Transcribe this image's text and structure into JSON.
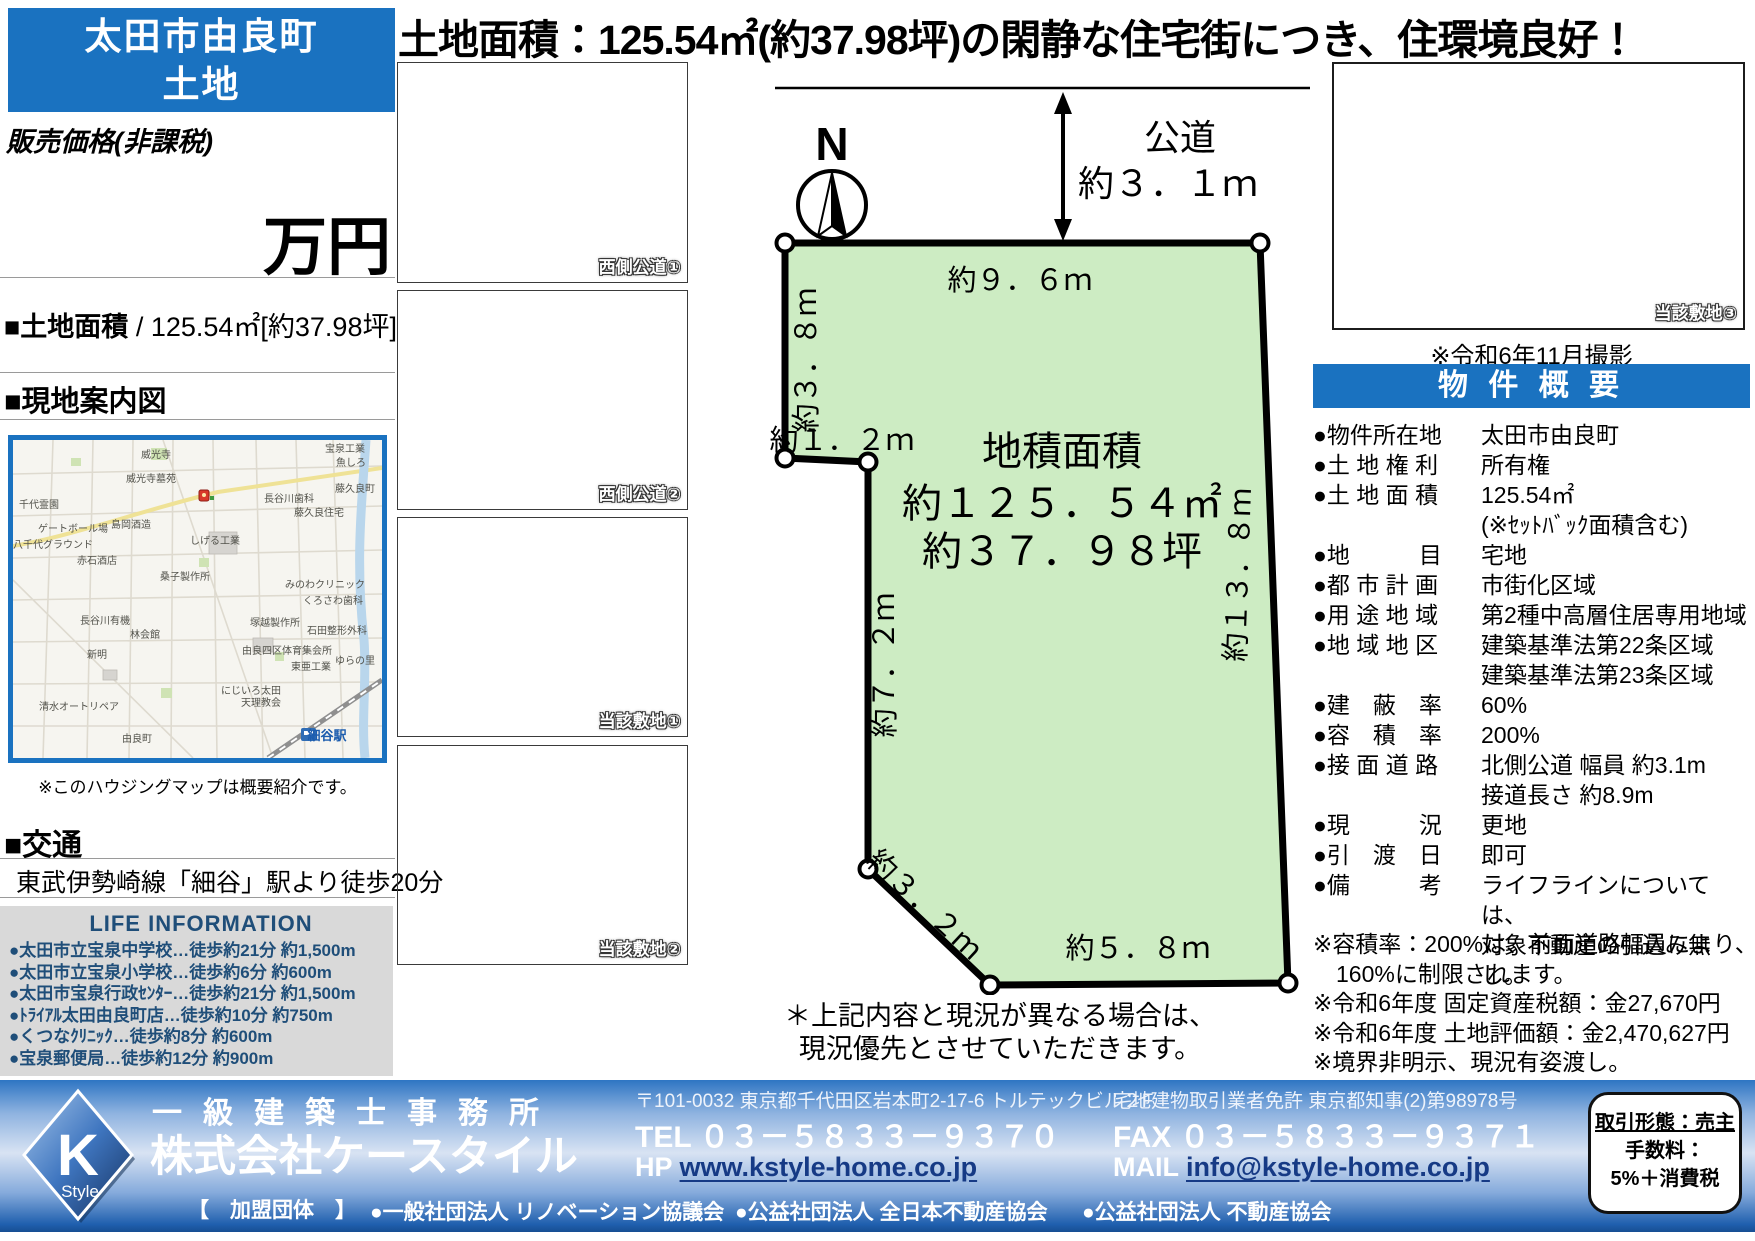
{
  "page": {
    "headline": "土地面積：125.54㎡(約37.98坪)の閑静な住宅街につき、住環境良好！"
  },
  "left": {
    "title_line1": "太田市由良町",
    "title_line2": "土地",
    "price_label": "販売価格(非課税)",
    "price_unit": "万円",
    "area_label": "■土地面積",
    "area_value": " / 125.54㎡[約37.98坪]",
    "map_header": "■現地案内図",
    "map_note": "※このハウジングマップは概要紹介です。",
    "access_header": "■交通",
    "access_value": "東武伊勢崎線「細谷」駅より徒歩20分",
    "life": {
      "header": "LIFE INFORMATION",
      "items": [
        "●太田市立宝泉中学校…徒歩約21分 約1,500m",
        "●太田市立宝泉小学校…徒歩約6分 約600m",
        "●太田市宝泉行政ｾﾝﾀｰ…徒歩約21分 約1,500m",
        "●ﾄﾗｲｱﾙ太田由良町店…徒歩約10分 約750m",
        "●くつなｸﾘﾆｯｸ…徒歩約8分 約600m",
        "●宝泉郵便局…徒歩約12分 約900m"
      ]
    }
  },
  "map": {
    "labels": [
      {
        "text": "宝泉工業",
        "x": 332,
        "y": 12
      },
      {
        "text": "魚しろ",
        "x": 338,
        "y": 26
      },
      {
        "text": "威光寺",
        "x": 143,
        "y": 18
      },
      {
        "text": "威光寺墓苑",
        "x": 138,
        "y": 42
      },
      {
        "text": "千代霊園",
        "x": 26,
        "y": 68
      },
      {
        "text": "藤久良町",
        "x": 342,
        "y": 52
      },
      {
        "text": "長谷川歯科",
        "x": 276,
        "y": 62
      },
      {
        "text": "藤久良住宅",
        "x": 306,
        "y": 76
      },
      {
        "text": "ゲートボール場",
        "x": 60,
        "y": 92
      },
      {
        "text": "島岡酒造",
        "x": 118,
        "y": 88
      },
      {
        "text": "八千代グラウンド",
        "x": 40,
        "y": 108
      },
      {
        "text": "しげる工業",
        "x": 202,
        "y": 104
      },
      {
        "text": "赤石酒店",
        "x": 84,
        "y": 124
      },
      {
        "text": "桑子製作所",
        "x": 172,
        "y": 140
      },
      {
        "text": "みのわクリニック",
        "x": 312,
        "y": 148
      },
      {
        "text": "くろさわ歯科",
        "x": 320,
        "y": 164
      },
      {
        "text": "長谷川有機",
        "x": 92,
        "y": 184
      },
      {
        "text": "塚越製作所",
        "x": 262,
        "y": 186
      },
      {
        "text": "林会館",
        "x": 132,
        "y": 198
      },
      {
        "text": "石田整形外科",
        "x": 324,
        "y": 194
      },
      {
        "text": "新明",
        "x": 84,
        "y": 218
      },
      {
        "text": "由良四区体育集会所",
        "x": 274,
        "y": 214
      },
      {
        "text": "東亜工業",
        "x": 298,
        "y": 230
      },
      {
        "text": "ゆらの里",
        "x": 342,
        "y": 224
      },
      {
        "text": "にじいろ太田",
        "x": 238,
        "y": 254
      },
      {
        "text": "天理教会",
        "x": 248,
        "y": 266
      },
      {
        "text": "清水オートリペア",
        "x": 66,
        "y": 270
      },
      {
        "text": "由良町",
        "x": 124,
        "y": 302
      },
      {
        "text": "細谷駅",
        "x": 314,
        "y": 300,
        "cls": "st"
      }
    ]
  },
  "photos": {
    "captions": [
      "西側公道①",
      "西側公道②",
      "当該敷地①",
      "当該敷地②",
      "当該敷地③"
    ],
    "shot_note": "※令和6年11月撮影"
  },
  "plot": {
    "north": "N",
    "road_label1": "公道",
    "road_label2": "約３．１ｍ",
    "top": "約９．６ｍ",
    "left1": "約３．８ｍ",
    "step": "約１．２ｍ",
    "left2": "約７．２ｍ",
    "right": "約１３．８ｍ",
    "diag": "約３．２ｍ",
    "bottom": "約５．８ｍ",
    "area_title": "地積面積",
    "area_m2": "約１２５．５４㎡",
    "area_tsubo": "約３７．９８坪",
    "disclaimer1": "＊上記内容と現況が異なる場合は、",
    "disclaimer2": "現況優先とさせていただきます。"
  },
  "overview": {
    "header": "物 件 概 要",
    "rows": [
      {
        "label": "●物件所在地",
        "value": "太田市由良町"
      },
      {
        "label": "●土 地 権 利",
        "value": "所有権"
      },
      {
        "label": "●土 地 面 積",
        "value": "125.54㎡\n(※ｾｯﾄﾊﾞｯｸ面積含む)"
      },
      {
        "label": "●地　　　目",
        "value": "宅地"
      },
      {
        "label": "●都 市 計 画",
        "value": "市街化区域"
      },
      {
        "label": "●用 途 地 域",
        "value": "第2種中高層住居専用地域"
      },
      {
        "label": "●地 域 地 区",
        "value": "建築基準法第22条区域\n建築基準法第23条区域"
      },
      {
        "label": "●建　蔽　率",
        "value": "60%"
      },
      {
        "label": "●容　積　率",
        "value": "200%"
      },
      {
        "label": "●接 面 道 路",
        "value": "北側公道 幅員 約3.1m\n接道長さ 約8.9m"
      },
      {
        "label": "●現　　　況",
        "value": "更地"
      },
      {
        "label": "●引　渡　日",
        "value": "即可"
      },
      {
        "label": "●備　　　考",
        "value": "ライフラインについては、\n対象不動産の引込み無し。"
      }
    ],
    "notes": [
      "※容積率：200%は、前面道路幅員により、\n　160%に制限されます。",
      "※令和6年度 固定資産税額：金27,670円",
      "※令和6年度 土地評価額：金2,470,627円",
      "※境界非明示、現況有姿渡し。"
    ]
  },
  "footer": {
    "logo_k": "K",
    "logo_style": "Style",
    "office_type": "一級建築士事務所",
    "company": "株式会社ケースタイル",
    "membership": "【　加盟団体　】",
    "address": "〒101-0032 東京都千代田区岩本町2-17-6 トルテックビル２F",
    "license": "宅地建物取引業者免許 東京都知事(2)第98978号",
    "tel_label": "TEL",
    "tel": "０３－５８３３－９３７０",
    "fax_label": "FAX",
    "fax": "０３－５８３３－９３７１",
    "hp_label": "HP",
    "hp": "www.kstyle-home.co.jp",
    "mail_label": "MAIL",
    "mail": "info@kstyle-home.co.jp",
    "associations": [
      "●一般社団法人 リノベーション協議会",
      "●公益社団法人 全日本不動産協会",
      "●公益社団法人 不動産協会"
    ],
    "deal_box": {
      "line1": "取引形態：売主",
      "line2": "手数料：",
      "line3": "5%＋消費税"
    }
  },
  "colors": {
    "brand_blue": "#1a72c0",
    "plot_green": "#cdecc3",
    "navy_text": "#1f4e79"
  }
}
